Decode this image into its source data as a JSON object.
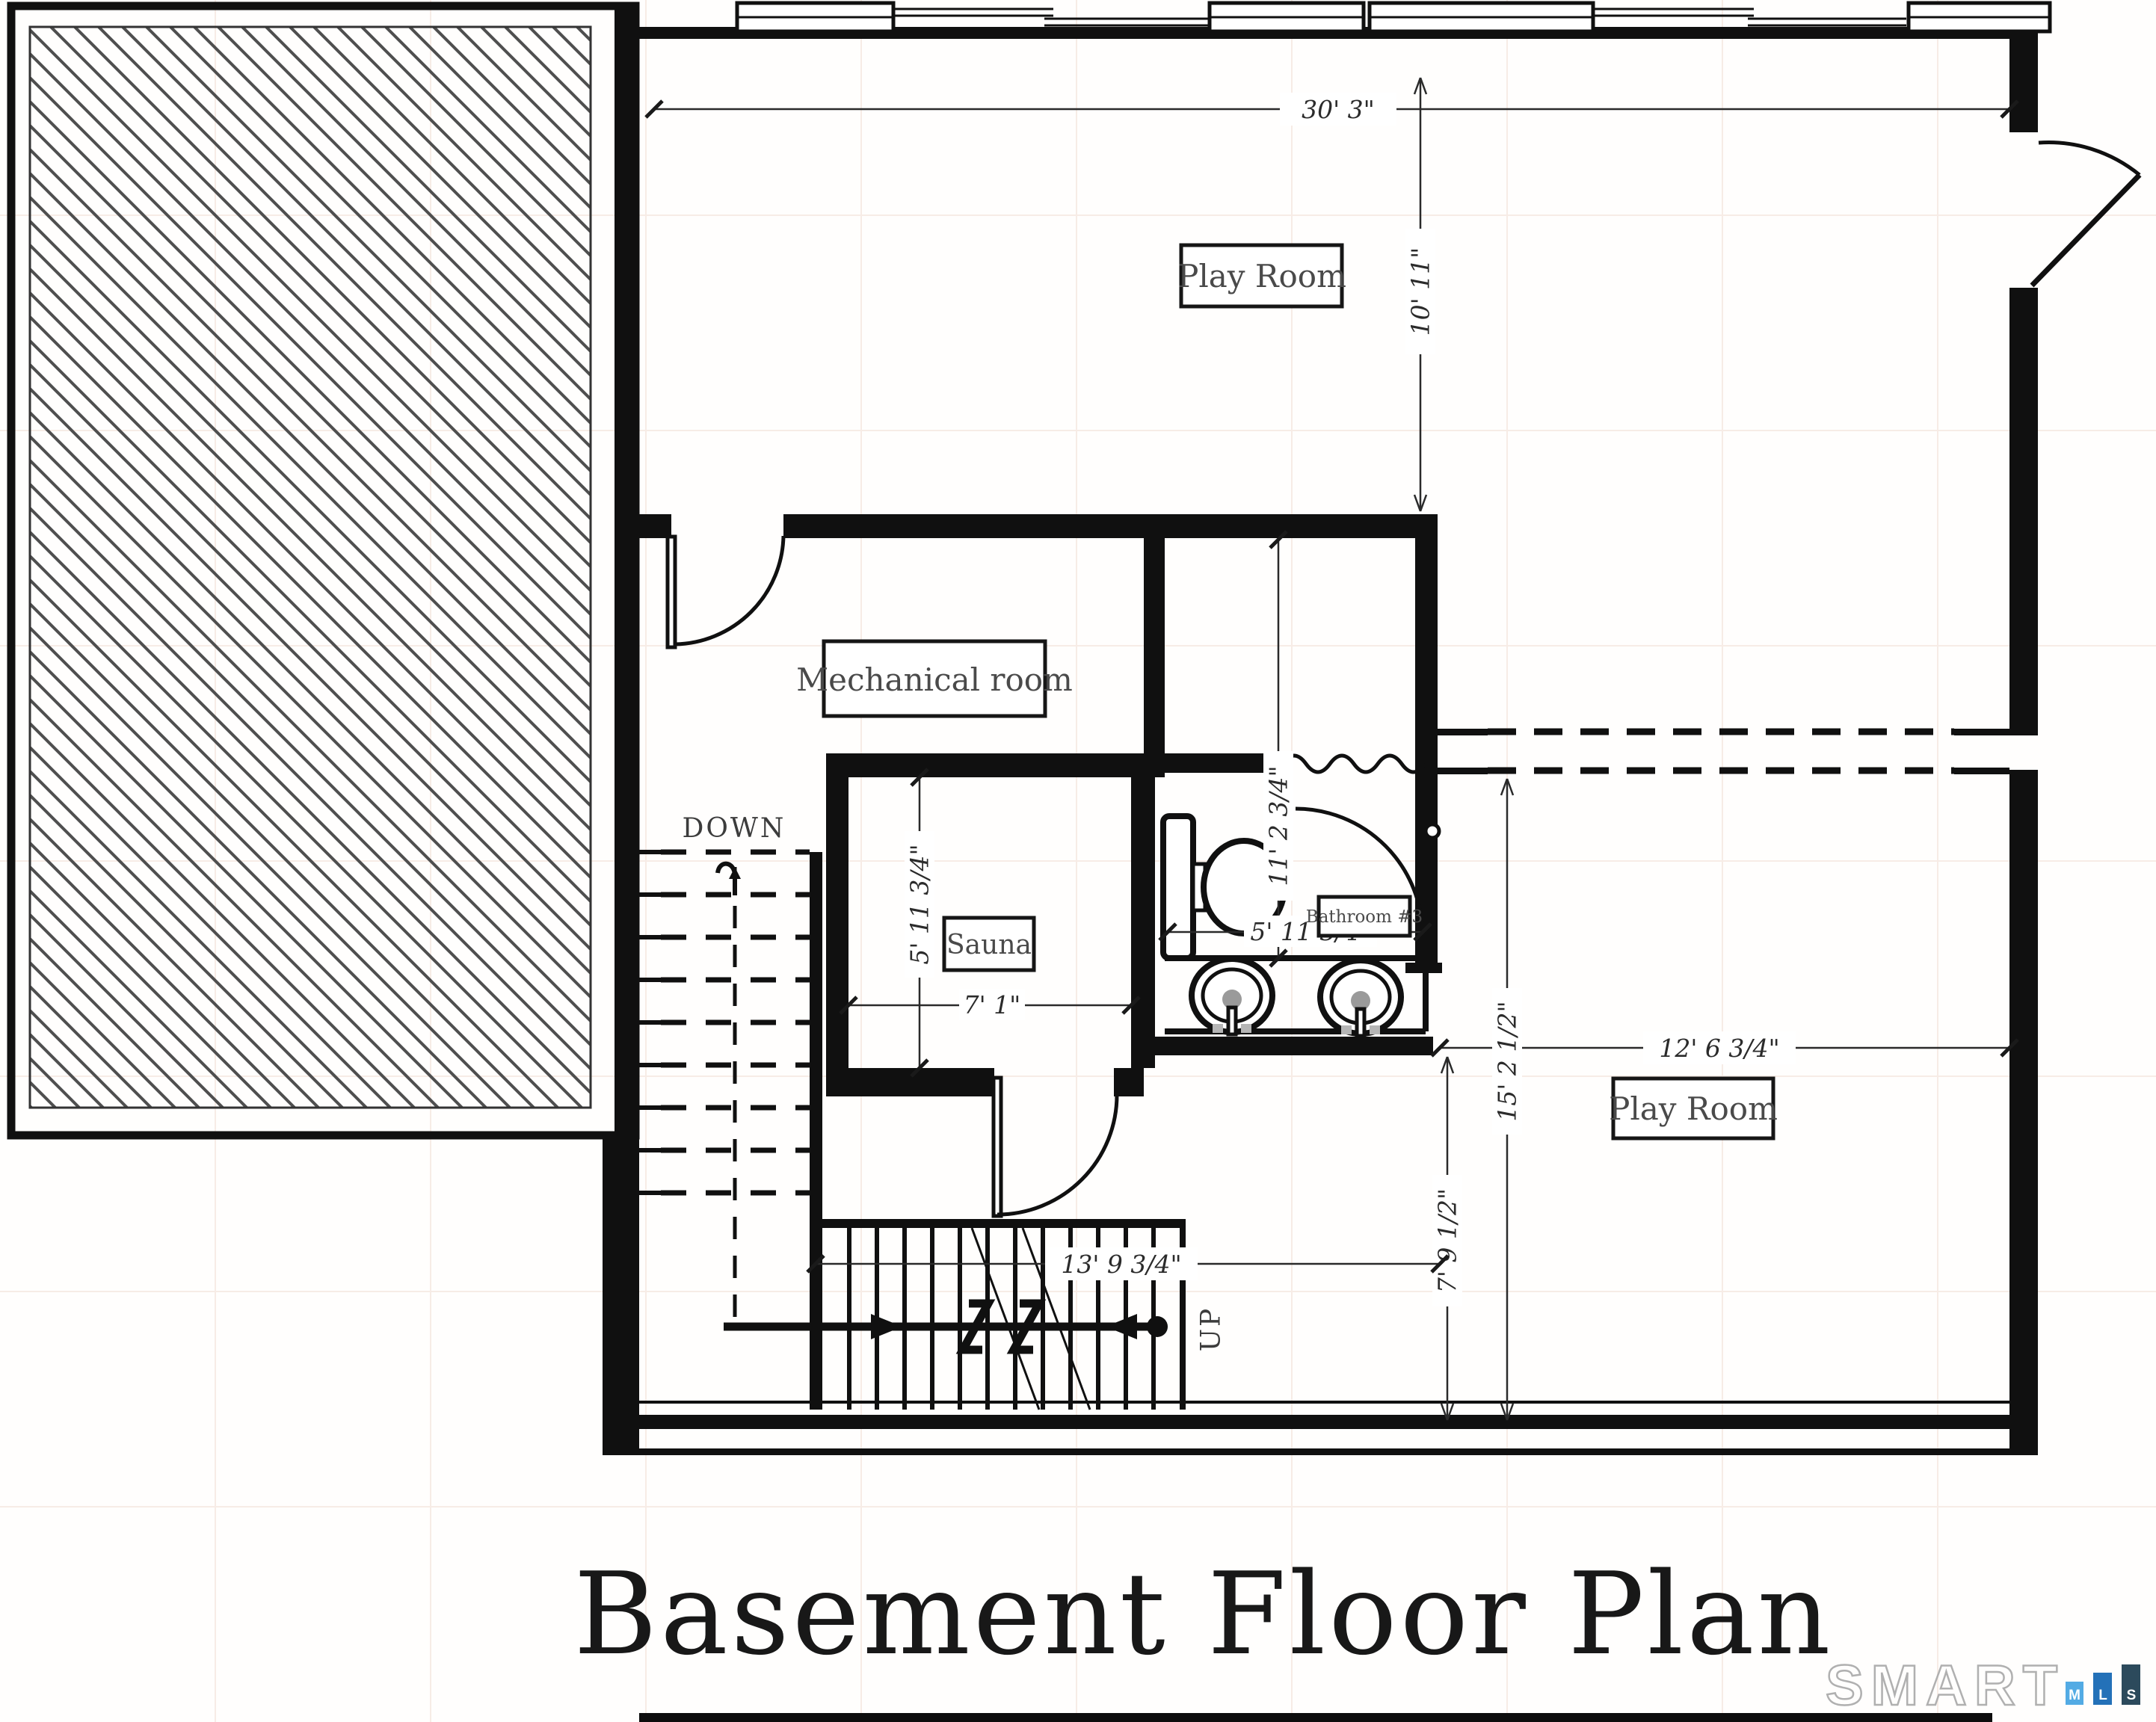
{
  "title": "Basement Floor Plan",
  "rooms": {
    "play_room_top": "Play Room",
    "mechanical": "Mechanical room",
    "sauna": "Sauna",
    "bathroom": "Bathroom #3",
    "play_room_right": "Play Room"
  },
  "stairs": {
    "down": "DOWN",
    "up": "UP"
  },
  "dims": {
    "overall_width": "30' 3\"",
    "play_top_depth": "10' 11\"",
    "bath_length": "11' 2 3/4\"",
    "bath_width": "5' 11 3/4\"",
    "sauna_depth": "5' 11 3/4\"",
    "sauna_width": "7' 1\"",
    "play_right_width": "12' 6 3/4\"",
    "play_right_depth": "15' 2 1/2\"",
    "lower_width": "13' 9 3/4\"",
    "stair_run": "7' 9 1/2\""
  },
  "logo": {
    "brand": "SMART",
    "m": "M",
    "l": "L",
    "s": "S"
  },
  "colors": {
    "wall": "#101010",
    "hatch": "#4f4f4f",
    "logo_m": "#53abe4",
    "logo_l": "#2471b8",
    "logo_s": "#2c4a5c"
  }
}
